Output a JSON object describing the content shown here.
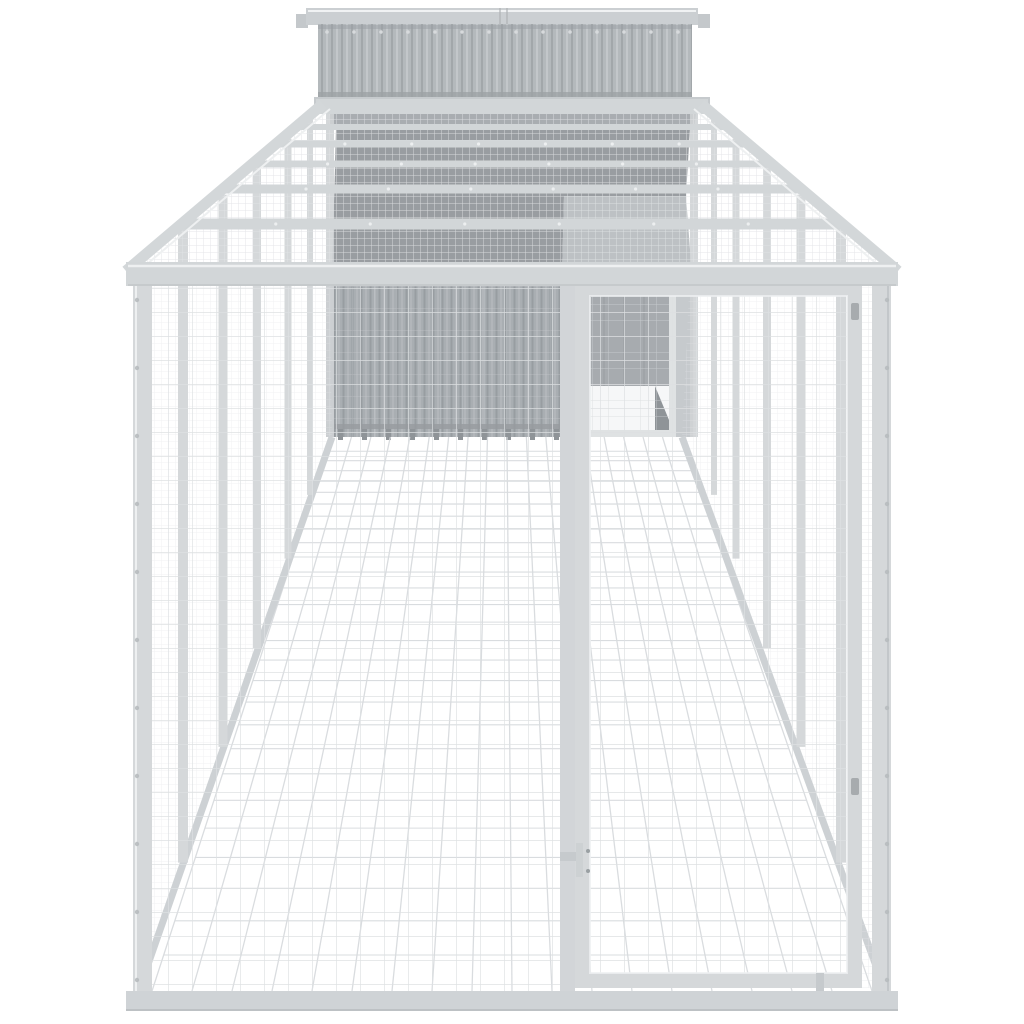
{
  "scene": {
    "type": "product-photo",
    "subject": "Outdoor chicken coop / dog kennel with long wire mesh run, front mesh door and corrugated steel house at the far end",
    "background": "#ffffff",
    "parts": {
      "coop_house": "corrugated light-grey steel coop house with flat roof cap",
      "roof_cap": "flat roof cap panel with centre seam and end brackets",
      "run_roof": "wire mesh run roof with cross rails",
      "house_roof": "sloped house roof seen through the mesh roof",
      "left_wall": "wire mesh side wall with upright posts",
      "right_wall": "wire mesh side wall with upright posts",
      "back_wall": "corrugated house front wall with mesh overlay and base feet",
      "interior_door": "small mesh access door beside the house",
      "floor": "wire mesh floor grid receding to the house",
      "front_panel": "front wire mesh panel",
      "front_door": "full-height front mesh door with latch, hinges and drop bolt",
      "frame": "light grey galvanised steel frame with bolt heads"
    },
    "palette": {
      "background": "#ffffff",
      "frame": "#d5d8da",
      "frame_light": "#eef0f1",
      "frame_shade": "#c3c7ca",
      "rail": "#d2d6d8",
      "cap": "#cbcfd2",
      "cap_tab": "#c4c8cb",
      "clerestory": "#b4b9bc",
      "house_wall": "#a9aeb2",
      "roof_dark": "#999da1",
      "roof_mid": "#a9adb1",
      "roof_lit": "#bdc1c4",
      "roof_strip": "#c6cacd",
      "open_area": "#c6cacd",
      "interior_shadow": "#a7abaf",
      "wedge": "#8f9498",
      "mesh_fine": "#e2e4e6",
      "mesh_mid": "#dde0e2",
      "floor_line": "#d8dbde",
      "bolt": "#b7bbbe",
      "rivet": "#d7dadc",
      "foot": "#8f9498",
      "hinge": "#a7abae",
      "latch": "#c6cacd",
      "bar_dot": "#f0f2f3"
    }
  }
}
